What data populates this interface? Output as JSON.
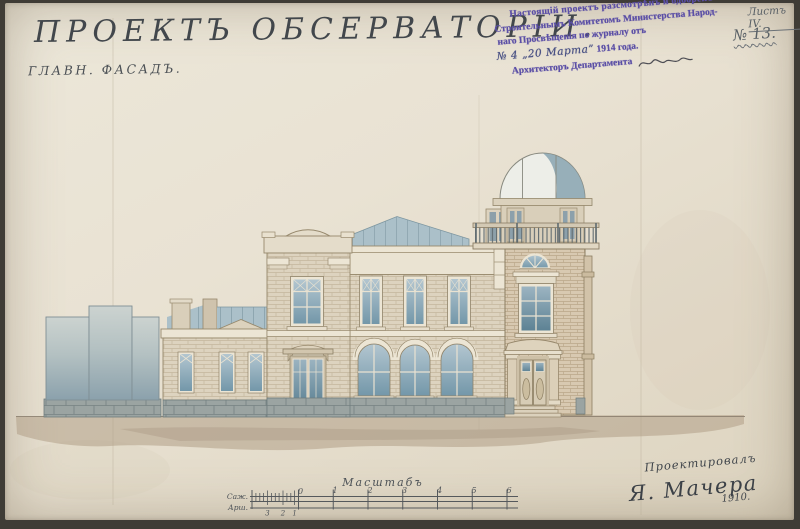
{
  "document": {
    "title": "ПРОЕКТЪ ОБСЕРВАТОРІИ.",
    "subtitle": "ГЛАВН. ФАСАДЪ.",
    "sheet_label": "Листъ IV.",
    "sheet_number": "№ 13.",
    "stamp": {
      "line1": "Настоящій проектъ разсмотрѣнъ и одобренъ",
      "line2": "Строительнымъ Комитетомъ Министерства Народ-",
      "line3": "наго Просвѣщенія по журналу отъ",
      "line4_hand": "№ 4  „20 Марта”",
      "line4_print": "1914 года.",
      "line5": "Архитекторъ Департамента"
    },
    "scale_bar": {
      "title": "Масштабъ",
      "unit_top": "Саж.",
      "unit_bottom": "Арш.",
      "major_numbers": [
        "0",
        "1",
        "2",
        "3",
        "4",
        "5",
        "6"
      ],
      "minor_numbers": [
        "3",
        "2",
        "1"
      ]
    },
    "signature": {
      "caption": "Проектировалъ",
      "name": "Я. Мачера",
      "year": "1910."
    }
  },
  "palette": {
    "paper": "#e9e2d3",
    "photo_bg": "#3f3c36",
    "ink": "#4b5055",
    "title_ink": "#42474c",
    "stamp_purple": "#5b4fa6",
    "hand_ink": "#474f83",
    "glass_blue": "#8fadbd",
    "metal_roof": "#abc0c9",
    "dome_shade": "#8ba6b2",
    "brick_light": "#ddd3bf",
    "brick_tower": "#d8c9b1",
    "trim_white": "#ece5d4",
    "stone_base": "#9ba4a2",
    "ground_wash": "#b09e86",
    "fence_blue": "#8ba1ac"
  }
}
